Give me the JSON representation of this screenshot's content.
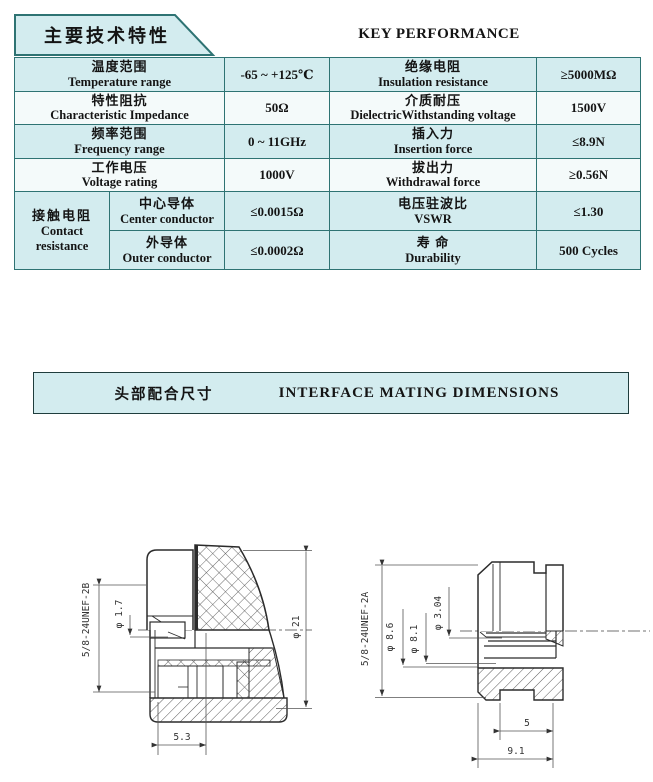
{
  "spec_table": {
    "title_zh": "主要技术特性",
    "title_en": "KEY PERFORMANCE",
    "group": {
      "zh": "接触电阻",
      "en1": "Contact",
      "en2": "resistance"
    },
    "rows": [
      {
        "p1_zh": "温度范围",
        "p1_en": "Temperature range",
        "v1": "-65 ~ +125℃",
        "p2_zh": "绝缘电阻",
        "p2_en": "Insulation resistance",
        "v2": "≥5000MΩ"
      },
      {
        "p1_zh": "特性阻抗",
        "p1_en": "Characteristic Impedance",
        "v1": "50Ω",
        "p2_zh": "介质耐压",
        "p2_en": "DielectricWithstanding voltage",
        "v2": "1500V"
      },
      {
        "p1_zh": "频率范围",
        "p1_en": "Frequency range",
        "v1": "0 ~ 11GHz",
        "p2_zh": "插入力",
        "p2_en": "Insertion force",
        "v2": "≤8.9N"
      },
      {
        "p1_zh": "工作电压",
        "p1_en": "Voltage rating",
        "v1": "1000V",
        "p2_zh": "拔出力",
        "p2_en": "Withdrawal force",
        "v2": "≥0.56N"
      },
      {
        "p1_zh": "中心导体",
        "p1_en": "Center conductor",
        "v1": "≤0.0015Ω",
        "p2_zh": "电压驻波比",
        "p2_en": "VSWR",
        "v2": "≤1.30"
      },
      {
        "p1_zh": "外导体",
        "p1_en": "Outer conductor",
        "v1": "≤0.0002Ω",
        "p2_zh": "寿  命",
        "p2_en": "Durability",
        "v2": "500 Cycles"
      }
    ]
  },
  "interface_section": {
    "title_zh": "头部配合尺寸",
    "title_en": "INTERFACE MATING DIMENSIONS"
  },
  "plug_drawing": {
    "thread": "5/8-24UNEF-2B",
    "pin_dia": "φ 1.7",
    "outer_dia": "φ 21",
    "depth": "5.3"
  },
  "jack_drawing": {
    "thread": "5/8-24UNEF-2A",
    "dia_a": "φ 8.6",
    "dia_b": "φ 8.1",
    "dia_c": "φ 3.04",
    "len_a": "5",
    "len_b": "9.1"
  },
  "colors": {
    "accent_fill": "#d3ecef",
    "row_alt": "#f4fafa",
    "border_teal": "#2e7373"
  }
}
